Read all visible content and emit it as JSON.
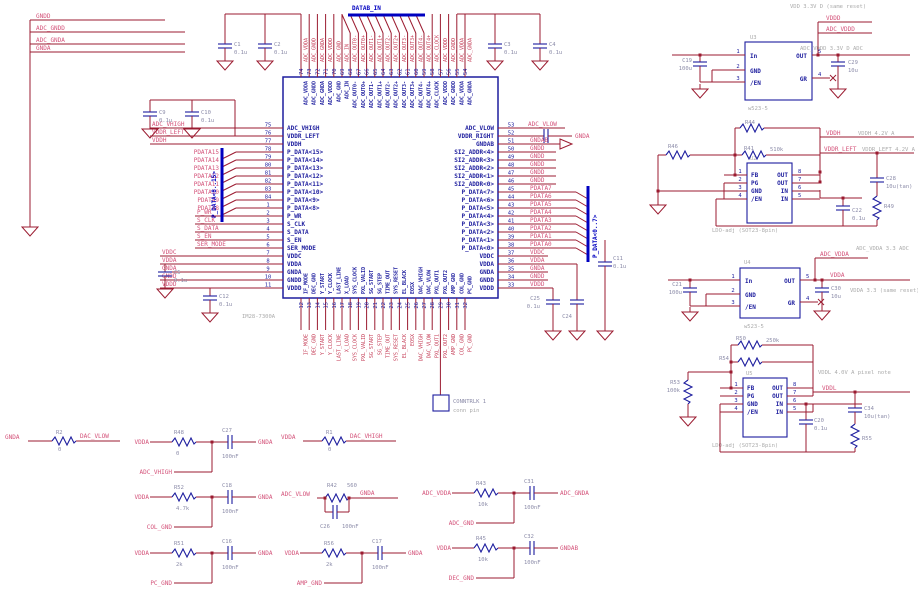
{
  "colors": {
    "wire": "#9b1b30",
    "component": "#1d1d9e",
    "bus": "#0000c0",
    "net_label": "#d4537a",
    "net_label_red": "#c43b55",
    "note_gray": "#ababab",
    "background": "#ffffff"
  },
  "top_left_nets": [
    "GNDD",
    "ADC_GNDD",
    "ADC_GNDA",
    "GNDA"
  ],
  "buses": {
    "top": "DATAB_IN",
    "left": "P_DATA<8..15>",
    "right": "P_DATA<0..7>"
  },
  "ic": {
    "part": "IM28-7300A",
    "left_pins": [
      [
        "75",
        "ADC_VHIGH",
        "ADC_VHIGH"
      ],
      [
        "76",
        "VDDR_LEFT",
        "VDDR_LEFT"
      ],
      [
        "77",
        "VDDH",
        "VDDH"
      ],
      [
        "78",
        "P_DATA<15>",
        "PDATA15"
      ],
      [
        "79",
        "P_DATA<14>",
        "PDATA14"
      ],
      [
        "80",
        "P_DATA<13>",
        "PDATA13"
      ],
      [
        "81",
        "P_DATA<12>",
        "PDATA12"
      ],
      [
        "82",
        "P_DATA<11>",
        "PDATA11"
      ],
      [
        "83",
        "P_DATA<10>",
        "PDATA10"
      ],
      [
        "84",
        "P_DATA<9>",
        "PDATA9"
      ],
      [
        "1",
        "P_DATA<8>",
        "PDATA8"
      ],
      [
        "2",
        "P_WR",
        "P_WR"
      ],
      [
        "3",
        "S_CLK",
        "S_CLK"
      ],
      [
        "4",
        "S_DATA",
        "S_DATA"
      ],
      [
        "5",
        "S_EN",
        "S_EN"
      ],
      [
        "6",
        "SER_MODE",
        "SER_MODE"
      ],
      [
        "7",
        "VDDC",
        "VDDC"
      ],
      [
        "8",
        "VDDA",
        "VDDA"
      ],
      [
        "9",
        "GNDA",
        "GNDA"
      ],
      [
        "10",
        "GNDD",
        "GNDD"
      ],
      [
        "11",
        "VDDD",
        "VDDD"
      ]
    ],
    "right_pins": [
      [
        "53",
        "ADC_VLOW",
        "ADC_VLOW"
      ],
      [
        "52",
        "VDDR_RIGHT",
        "GNDA"
      ],
      [
        "51",
        "GNDAB",
        "GNDAB"
      ],
      [
        "50",
        "SI2_ADDR<4>",
        "GNDD"
      ],
      [
        "49",
        "SI2_ADDR<3>",
        "GNDD"
      ],
      [
        "48",
        "SI2_ADDR<2>",
        "GNDD"
      ],
      [
        "47",
        "SI2_ADDR<1>",
        "GNDD"
      ],
      [
        "46",
        "SI2_ADDR<0>",
        "GNDD"
      ],
      [
        "45",
        "P_DATA<7>",
        "PDATA7"
      ],
      [
        "44",
        "P_DATA<6>",
        "PDATA6"
      ],
      [
        "43",
        "P_DATA<5>",
        "PDATA5"
      ],
      [
        "42",
        "P_DATA<4>",
        "PDATA4"
      ],
      [
        "41",
        "P_DATA<3>",
        "PDATA3"
      ],
      [
        "40",
        "P_DATA<2>",
        "PDATA2"
      ],
      [
        "39",
        "P_DATA<1>",
        "PDATA1"
      ],
      [
        "38",
        "P_DATA<0>",
        "PDATA0"
      ],
      [
        "37",
        "VDDC",
        "VDDC"
      ],
      [
        "36",
        "VDDA",
        "VDDA"
      ],
      [
        "35",
        "GNDA",
        "GNDA"
      ],
      [
        "34",
        "GNDD",
        "GNDD"
      ],
      [
        "33",
        "VDDD",
        "VDDD"
      ]
    ],
    "top_pins": [
      [
        "74",
        "ADC_VDDA"
      ],
      [
        "73",
        "ADC_GNDD"
      ],
      [
        "72",
        "ADC_GNDA"
      ],
      [
        "71",
        "ADC_VDDD"
      ],
      [
        "70",
        "ADC_GND"
      ],
      [
        "69",
        "ADC_IN"
      ],
      [
        "68",
        "ADC_OUT0-"
      ],
      [
        "67",
        "ADC_OUT0+"
      ],
      [
        "66",
        "ADC_OUT1-"
      ],
      [
        "65",
        "ADC_OUT1+"
      ],
      [
        "64",
        "ADC_OUT2-"
      ],
      [
        "63",
        "ADC_OUT2+"
      ],
      [
        "62",
        "ADC_OUT3-"
      ],
      [
        "61",
        "ADC_OUT3+"
      ],
      [
        "60",
        "ADC_OUT4-"
      ],
      [
        "59",
        "ADC_OUT4+"
      ],
      [
        "58",
        "ADC_CLOCK"
      ],
      [
        "57",
        "ADC_VDDD"
      ],
      [
        "56",
        "ADC_GNDD"
      ],
      [
        "55",
        "ADC_VDDA"
      ],
      [
        "54",
        "ADC_GNDA"
      ]
    ],
    "bottom_pins": [
      [
        "12",
        "IF_MODE"
      ],
      [
        "13",
        "DEC_GND"
      ],
      [
        "14",
        "Y_START"
      ],
      [
        "15",
        "Y_CLOCK"
      ],
      [
        "16",
        "LAST_LINE"
      ],
      [
        "17",
        "X_LOAD"
      ],
      [
        "18",
        "SYS_CLOCK"
      ],
      [
        "19",
        "PXL_VALID"
      ],
      [
        "20",
        "SG_START"
      ],
      [
        "21",
        "SG_STEP"
      ],
      [
        "22",
        "TIME_OUT"
      ],
      [
        "23",
        "SYS_RESET"
      ],
      [
        "24",
        "EL_BLACK"
      ],
      [
        "25",
        "EOSX"
      ],
      [
        "26",
        "DAC_VHIGH"
      ],
      [
        "27",
        "DAC_VLOW"
      ],
      [
        "28",
        "PXL_OUT1"
      ],
      [
        "29",
        "PXL_OUT2"
      ],
      [
        "30",
        "AMP_GND"
      ],
      [
        "31",
        "COL_GND"
      ],
      [
        "32",
        "PC_GND"
      ]
    ]
  },
  "caps": {
    "c1": [
      "C1",
      "0.1u"
    ],
    "c2": [
      "C2",
      "0.1u"
    ],
    "c3": [
      "C3",
      "0.1u"
    ],
    "c4": [
      "C4",
      "0.1u"
    ],
    "c9": [
      "C9",
      "0.1u"
    ],
    "c10": [
      "C10",
      "0.1u"
    ],
    "c5": [
      "C5",
      "0.1u"
    ],
    "c12": [
      "C12",
      "0.1u"
    ],
    "c25": [
      "C25",
      "0.1u"
    ],
    "c24": [
      "C24",
      "0.1u"
    ],
    "c11": [
      "C11",
      "0.1u"
    ]
  },
  "regulators": {
    "a": {
      "ref": "U3",
      "part": "w523-5",
      "pins_left": [
        [
          "1",
          "In"
        ],
        [
          "2",
          "GND"
        ],
        [
          "3",
          "/EN"
        ]
      ],
      "pins_right": [
        [
          "5",
          "OUT"
        ],
        [
          "4",
          "GR"
        ]
      ],
      "cap_in": [
        "C19",
        "100u"
      ],
      "cap_out": [
        "C29",
        "10u"
      ],
      "net1": "VDDD",
      "net2": "ADC_VDDD",
      "note1": "VDD 3.3V D (same reset)",
      "note2": "ADC_VDDD 3.3V D ADC"
    },
    "b": {
      "ref": "U2",
      "part": "LDO-adj (SOT23-8pin)",
      "pins_left": [
        [
          "1",
          "FB"
        ],
        [
          "2",
          "PG"
        ],
        [
          "3",
          "GND"
        ],
        [
          "4",
          "/EN"
        ]
      ],
      "pins_right": [
        [
          "8",
          "OUT"
        ],
        [
          "7",
          "OUT"
        ],
        [
          "6",
          "IN"
        ],
        [
          "5",
          "IN"
        ]
      ],
      "r_top": [
        "R44",
        ""
      ],
      "r_fb": [
        "R41",
        "510k"
      ],
      "r_left": [
        "R46",
        ""
      ],
      "cap_in": [
        "C22",
        "0.1u"
      ],
      "cap_out": [
        "C28",
        "10u(tan)"
      ],
      "r_out": [
        "R49",
        ""
      ],
      "net1": "VDDH",
      "note1": "VDDH 4.2V A",
      "net2": "VDDR_LEFT",
      "note2": "VDDR_LEFT 4.2V A"
    },
    "c": {
      "ref": "U4",
      "part": "w523-5",
      "pins_left": [
        [
          "1",
          "In"
        ],
        [
          "2",
          "GND"
        ],
        [
          "3",
          "/EN"
        ]
      ],
      "pins_right": [
        [
          "5",
          "OUT"
        ],
        [
          "4",
          "GR"
        ]
      ],
      "cap_in": [
        "C21",
        "100u"
      ],
      "cap_out": [
        "C30",
        "10u"
      ],
      "net1": "ADC_VDDA",
      "note1": "ADC_VDDA 3.3 ADC",
      "net2": "VDDA",
      "note2": "VDDA 3.3 (same reset)"
    },
    "d": {
      "ref": "U5",
      "part": "LDO-adj (SOT23-8pin)",
      "pins_left": [
        [
          "1",
          "FB"
        ],
        [
          "2",
          "PG"
        ],
        [
          "3",
          "GND"
        ],
        [
          "4",
          "/EN"
        ]
      ],
      "pins_right": [
        [
          "8",
          "OUT"
        ],
        [
          "7",
          "OUT"
        ],
        [
          "6",
          "IN"
        ],
        [
          "5",
          "IN"
        ]
      ],
      "r_top": [
        "R50",
        "250k"
      ],
      "r_fb": [
        "R54",
        ""
      ],
      "r_left": [
        "R53",
        "100k"
      ],
      "cap_in": [
        "C20",
        "0.1u"
      ],
      "cap_out": [
        "C34",
        "10u(tan)"
      ],
      "r_out": [
        "R55",
        ""
      ],
      "net1": "VDDL",
      "note1": "VDDL 4.0V A pixel note"
    }
  },
  "connector": {
    "name": "CONNTRLK 1",
    "sub": "conn pin"
  },
  "rc": {
    "r2_row": {
      "left": "GNDA",
      "ref": "R2",
      "val": "0",
      "right": "DAC_VLOW"
    },
    "r1_row": {
      "left": "VDDA",
      "ref": "R1",
      "val": "0",
      "right": "DAC_VHIGH"
    },
    "shunt": {
      "left": "ADC_VLOW",
      "ref": "R42",
      "val": "560",
      "cap_ref": "C26",
      "cap_val": "100nF",
      "right": "GNDA"
    },
    "filters": [
      {
        "col": 0,
        "row": 0,
        "left": "VDDA",
        "res_ref": "R48",
        "res_val": "0",
        "cap_ref": "C27",
        "cap_val": "100nF",
        "right": "GNDA",
        "tap": "ADC_VHIGH"
      },
      {
        "col": 0,
        "row": 1,
        "left": "VDDA",
        "res_ref": "R52",
        "res_val": "4.7k",
        "cap_ref": "C18",
        "cap_val": "100nF",
        "right": "GNDA",
        "tap": "COL_GND"
      },
      {
        "col": 0,
        "row": 2,
        "left": "VDDA",
        "res_ref": "R51",
        "res_val": "2k",
        "cap_ref": "C16",
        "cap_val": "100nF",
        "right": "GNDA",
        "tap": "PC_GND"
      },
      {
        "col": 1,
        "row": 2,
        "left": "VDDA",
        "res_ref": "R56",
        "res_val": "2k",
        "cap_ref": "C17",
        "cap_val": "100nF",
        "right": "GNDA",
        "tap": "AMP_GND"
      },
      {
        "col": 2,
        "row": 0,
        "left": "ADC_VDDA",
        "res_ref": "R43",
        "res_val": "10k",
        "cap_ref": "C31",
        "cap_val": "100nF",
        "right": "ADC_GNDA",
        "tap": "ADC_GND"
      },
      {
        "col": 2,
        "row": 1,
        "left": "VDDA",
        "res_ref": "R45",
        "res_val": "10k",
        "cap_ref": "C32",
        "cap_val": "100nF",
        "right": "GNDAB",
        "tap": "DEC_GND"
      }
    ]
  }
}
